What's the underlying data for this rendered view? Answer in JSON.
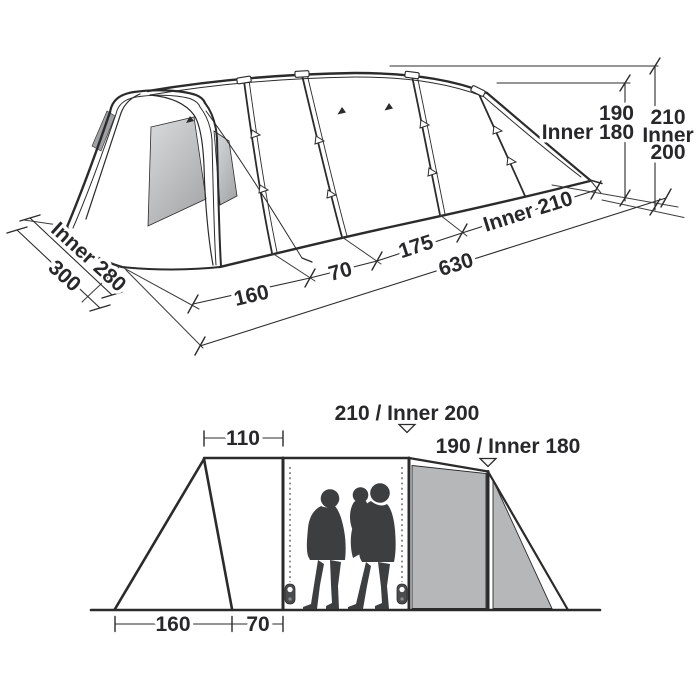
{
  "diagram_type": "tent dimension specification drawing",
  "colors": {
    "ink": "#2b2b2c",
    "panel_gray": "#b5b7b9",
    "panel_dark": "#9ea0a3",
    "silhouette": "#3d3e40",
    "background": "#ffffff"
  },
  "perspective_view": {
    "length_segment_1": "160",
    "length_segment_2": "70",
    "length_segment_3": "175",
    "total_length": "630",
    "inner_rear_length": "Inner 210",
    "inner_width": "Inner 280",
    "total_width": "300",
    "rear_height": "190",
    "rear_inner_height": "Inner 180",
    "peak_height": "210",
    "peak_inner_line1": "Inner",
    "peak_inner_line2": "200"
  },
  "elevation_view": {
    "peak_height_label": "210 / Inner 200",
    "rear_height_label": "190 / Inner 180",
    "porch_top_width": "110",
    "porch_base_width": "160",
    "door_base_width": "70"
  }
}
